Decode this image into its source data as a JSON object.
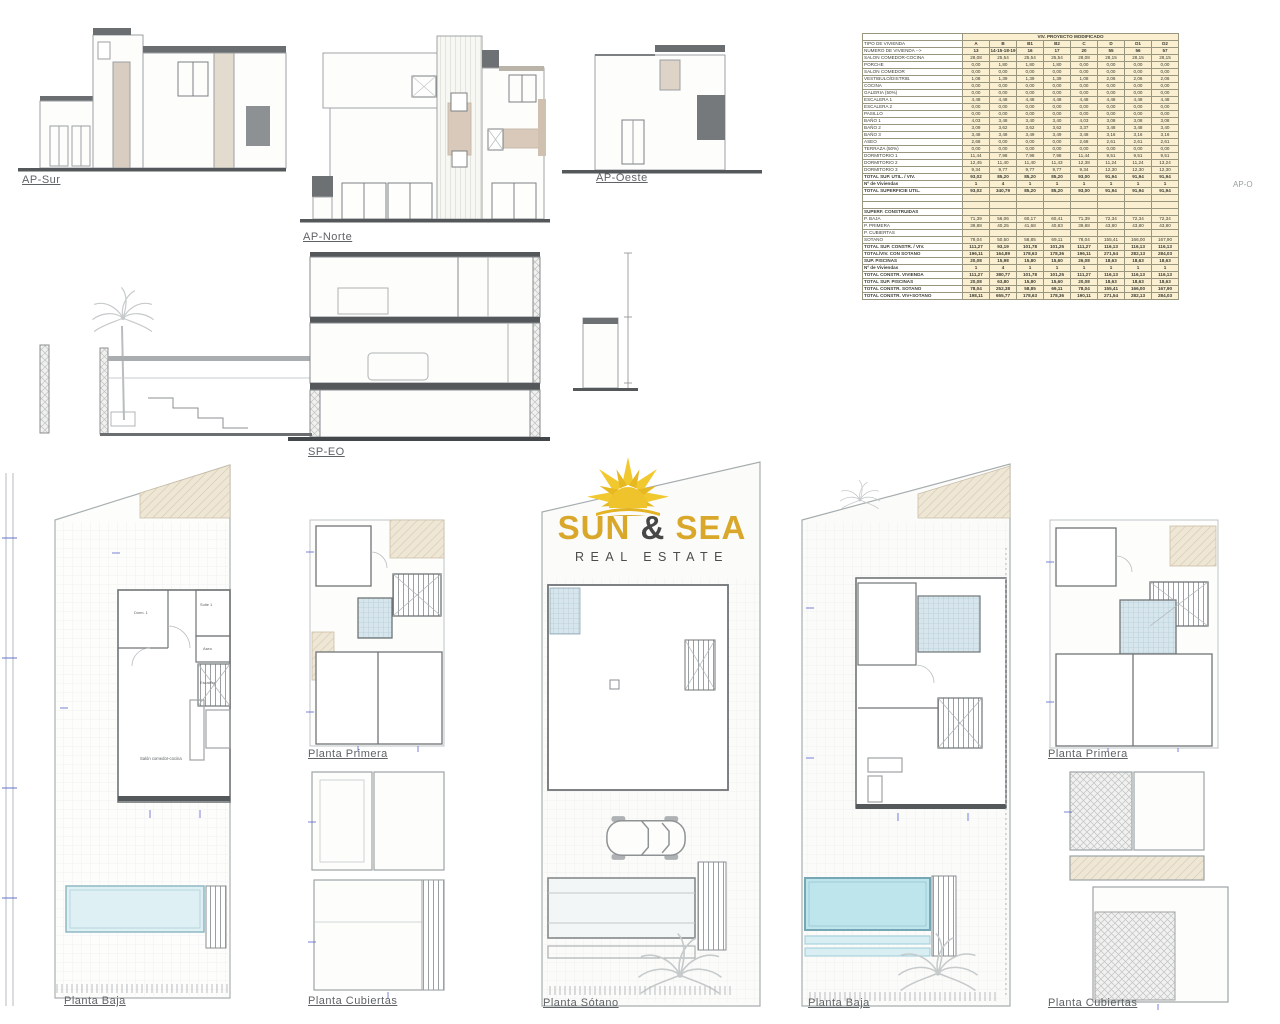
{
  "page": {
    "background": "#ffffff"
  },
  "logo": {
    "word1": "SUN",
    "amp": "&",
    "word2": "SEA",
    "tagline": "REAL ESTATE",
    "gold": "#d9a72a",
    "dark": "#474747",
    "sun_yellow": "#f0c92f"
  },
  "drawing_labels": {
    "ap_sur": "AP-Sur",
    "ap_norte": "AP-Norte",
    "ap_oeste": "AP-Oeste",
    "sp_eo": "SP-EO",
    "ap_o_partial": "AP-O",
    "planta_baja_left": "Planta Baja",
    "planta_primera_left": "Planta Primera",
    "planta_cubiertas_left": "Planta Cubiertas",
    "planta_sotano": "Planta Sótano",
    "planta_baja_right": "Planta Baja",
    "planta_primera_right": "Planta Primera",
    "planta_cubiertas_right": "Planta Cubiertas"
  },
  "plan_room_labels": {
    "dorm1": "Dorm. 1",
    "suite1": "Suite 1",
    "aseo": "Aseo",
    "escalera": "Escalera",
    "salon": "Salón comedor-cocina"
  },
  "table": {
    "title": "VIV. PROYECTO MODIFICADO",
    "tipo_label": "TIPO DE VIVIENDA",
    "columns": [
      "A",
      "B",
      "B1",
      "B2",
      "C",
      "D",
      "D1",
      "D2"
    ],
    "numero_label": "NUMERO DE VIVIENDA -->",
    "numero_values": [
      "13",
      "14-15-18-19",
      "16",
      "17",
      "20",
      "55",
      "56",
      "57"
    ],
    "rows": [
      {
        "style": "n",
        "label": "SALON COMEDOR-COCINA",
        "values": [
          "28,08",
          "25,54",
          "25,54",
          "25,54",
          "28,08",
          "28,15",
          "28,15",
          "28,15"
        ]
      },
      {
        "style": "n",
        "label": "PORCHE",
        "values": [
          "0,00",
          "1,80",
          "1,80",
          "1,80",
          "0,00",
          "0,00",
          "0,00",
          "0,00"
        ]
      },
      {
        "style": "n",
        "label": "SALON COMEDOR",
        "values": [
          "0,00",
          "0,00",
          "0,00",
          "0,00",
          "0,00",
          "0,00",
          "0,00",
          "0,00"
        ]
      },
      {
        "style": "n",
        "label": "VESTIBULO/DISTRIB.",
        "values": [
          "1,08",
          "1,39",
          "1,39",
          "1,39",
          "1,08",
          "2,06",
          "2,06",
          "2,06"
        ]
      },
      {
        "style": "n",
        "label": "COCINA",
        "values": [
          "0,00",
          "0,00",
          "0,00",
          "0,00",
          "0,00",
          "0,00",
          "0,00",
          "0,00"
        ]
      },
      {
        "style": "n",
        "label": "GALERIA (50%)",
        "values": [
          "0,00",
          "0,00",
          "0,00",
          "0,00",
          "0,00",
          "0,00",
          "0,00",
          "0,00"
        ]
      },
      {
        "style": "n",
        "label": "ESCALERA 1",
        "values": [
          "4,48",
          "4,48",
          "4,48",
          "4,48",
          "4,48",
          "4,48",
          "4,48",
          "4,48"
        ]
      },
      {
        "style": "n",
        "label": "ESCALERA 2",
        "values": [
          "0,00",
          "0,00",
          "0,00",
          "0,00",
          "0,00",
          "0,00",
          "0,00",
          "0,00"
        ]
      },
      {
        "style": "n",
        "label": "PASILLO",
        "values": [
          "0,00",
          "0,00",
          "0,00",
          "0,00",
          "0,00",
          "0,00",
          "0,00",
          "0,00"
        ]
      },
      {
        "style": "n",
        "label": "BAÑO 1",
        "values": [
          "4,03",
          "3,48",
          "3,40",
          "3,40",
          "4,03",
          "3,08",
          "3,08",
          "3,08"
        ]
      },
      {
        "style": "n",
        "label": "BAÑO 2",
        "values": [
          "3,09",
          "3,62",
          "3,62",
          "3,62",
          "3,37",
          "3,48",
          "3,48",
          "3,40"
        ]
      },
      {
        "style": "n",
        "label": "BAÑO 3",
        "values": [
          "3,48",
          "3,48",
          "3,49",
          "3,49",
          "3,48",
          "3,16",
          "3,16",
          "3,16"
        ]
      },
      {
        "style": "n",
        "label": "ASEO",
        "values": [
          "2,68",
          "0,00",
          "0,00",
          "0,00",
          "2,68",
          "2,61",
          "2,61",
          "2,61"
        ]
      },
      {
        "style": "n",
        "label": "TERRAZA (50%)",
        "values": [
          "0,00",
          "0,00",
          "0,00",
          "0,00",
          "0,00",
          "0,00",
          "0,00",
          "0,00"
        ]
      },
      {
        "style": "n",
        "label": "DORMITORIO 1",
        "values": [
          "11,44",
          "7,98",
          "7,98",
          "7,98",
          "11,44",
          "9,51",
          "9,51",
          "9,51"
        ]
      },
      {
        "style": "n",
        "label": "DORMITORIO 2",
        "values": [
          "12,45",
          "11,40",
          "11,40",
          "11,43",
          "12,38",
          "11,24",
          "11,24",
          "13,24"
        ]
      },
      {
        "style": "n",
        "label": "DORMITORIO 3",
        "values": [
          "9,34",
          "9,77",
          "9,77",
          "9,77",
          "9,34",
          "12,30",
          "12,30",
          "12,30"
        ]
      },
      {
        "style": "b",
        "label": "TOTAL SUP. UTIL. / VIV.",
        "values": [
          "93,02",
          "85,20",
          "85,20",
          "85,20",
          "93,00",
          "91,94",
          "91,94",
          "91,94"
        ]
      },
      {
        "style": "v",
        "label": "Nº de Viviendas",
        "values": [
          "1",
          "4",
          "1",
          "1",
          "1",
          "1",
          "1",
          "1"
        ]
      },
      {
        "style": "b2",
        "label": "TOTAL SUPERFICIE UTIL.",
        "values": [
          "93,02",
          "340,79",
          "85,20",
          "85,20",
          "93,00",
          "91,94",
          "91,94",
          "91,94"
        ]
      },
      {
        "style": "sp",
        "label": "",
        "values": [
          "",
          "",
          "",
          "",
          "",
          "",
          "",
          ""
        ]
      },
      {
        "style": "sp",
        "label": "",
        "values": [
          "",
          "",
          "",
          "",
          "",
          "",
          "",
          ""
        ]
      },
      {
        "style": "s",
        "label": "SUPERF. CONSTRUIDAS",
        "values": [
          "",
          "",
          "",
          "",
          "",
          "",
          "",
          ""
        ]
      },
      {
        "style": "r",
        "label": "P. BAJA",
        "values": [
          "71,39",
          "56,06",
          "60,17",
          "60,41",
          "71,39",
          "72,34",
          "72,34",
          "72,34"
        ]
      },
      {
        "style": "r",
        "label": "P. PRIMERA",
        "values": [
          "39,88",
          "40,25",
          "41,68",
          "40,83",
          "39,88",
          "43,80",
          "43,80",
          "43,80"
        ]
      },
      {
        "style": "r",
        "label": "P. CUBIERTAS",
        "values": [
          "",
          "",
          "",
          "",
          "",
          "",
          "",
          ""
        ]
      },
      {
        "style": "r",
        "label": "SOTANO",
        "values": [
          "78,04",
          "50,50",
          "58,85",
          "69,11",
          "78,04",
          "155,41",
          "166,00",
          "167,90"
        ]
      },
      {
        "style": "b",
        "label": "TOTAL SUP. CONSTR. / VIV.",
        "values": [
          "111,27",
          "93,19",
          "101,78",
          "101,25",
          "111,27",
          "116,13",
          "116,13",
          "116,13"
        ]
      },
      {
        "style": "b3",
        "label": "TOTAL/VIV. CON SOTANO",
        "values": [
          "196,11",
          "164,89",
          "178,63",
          "178,36",
          "196,11",
          "271,54",
          "282,13",
          "284,03"
        ]
      },
      {
        "style": "b3",
        "label": "SUP. PISCINAS",
        "values": [
          "20,08",
          "15,98",
          "15,80",
          "15,60",
          "26,08",
          "18,63",
          "18,63",
          "18,63"
        ]
      },
      {
        "style": "v",
        "label": "Nº de Viviendas",
        "values": [
          "1",
          "4",
          "1",
          "1",
          "1",
          "1",
          "1",
          "1"
        ]
      },
      {
        "style": "g",
        "label": "TOTAL CONSTR. VIVIENDA",
        "values": [
          "111,27",
          "380,77",
          "101,78",
          "101,25",
          "111,27",
          "116,13",
          "116,13",
          "116,13"
        ]
      },
      {
        "style": "g",
        "label": "TOTAL SUP. PISCINAS",
        "values": [
          "20,08",
          "63,80",
          "15,80",
          "15,60",
          "20,08",
          "18,63",
          "18,63",
          "18,63"
        ]
      },
      {
        "style": "g",
        "label": "TOTAL CONSTR. SOTANO",
        "values": [
          "78,04",
          "252,38",
          "58,85",
          "69,11",
          "78,04",
          "155,41",
          "166,00",
          "167,90"
        ]
      },
      {
        "style": "g",
        "label": "TOTAL CONSTR. VIV+SOTANO",
        "values": [
          "198,11",
          "655,77",
          "178,63",
          "178,36",
          "190,11",
          "271,54",
          "282,13",
          "284,03"
        ]
      }
    ]
  }
}
